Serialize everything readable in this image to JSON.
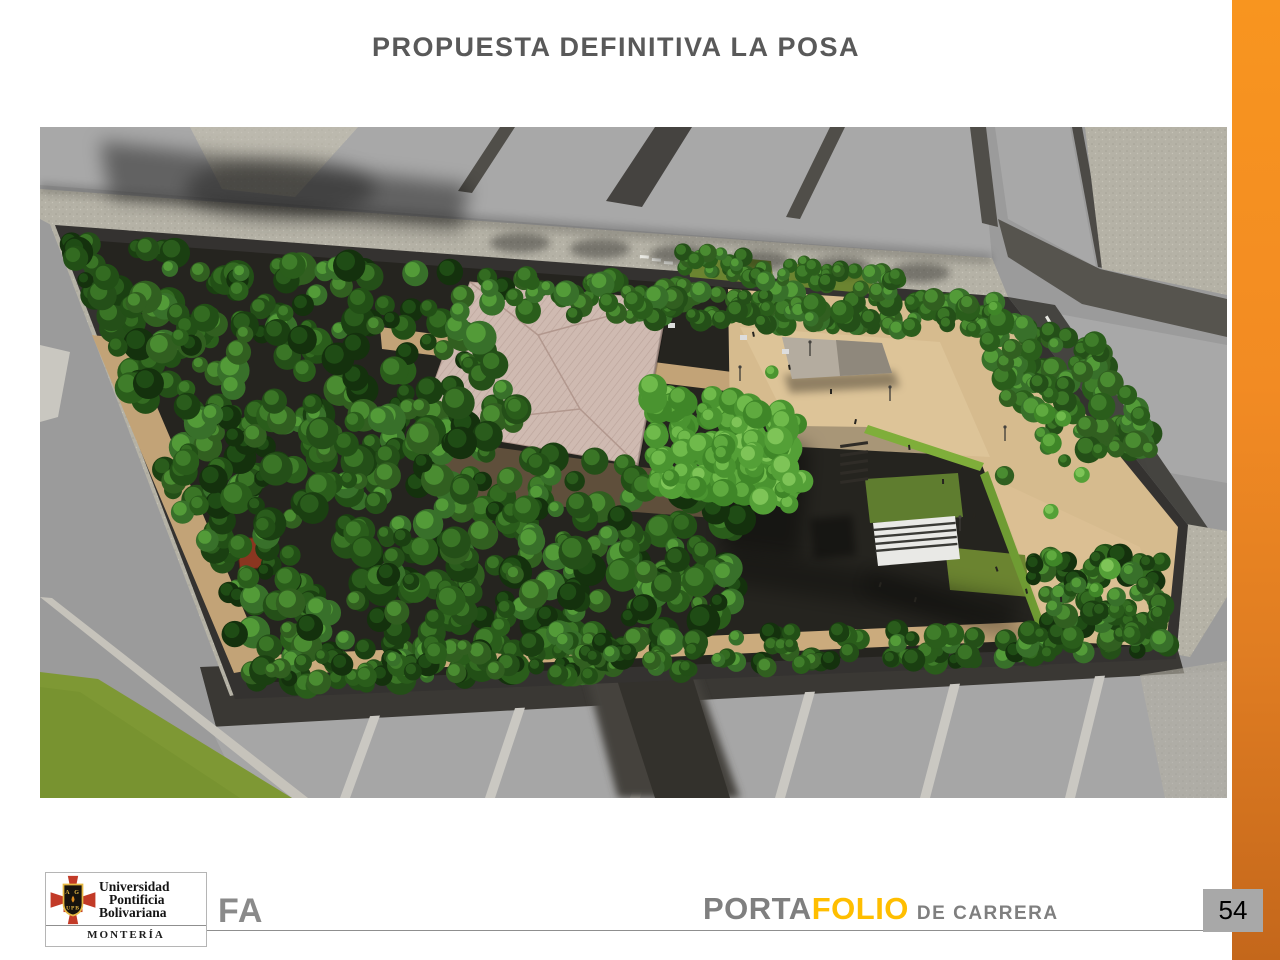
{
  "slide": {
    "title": "PROPUESTA DEFINITIVA LA POSA",
    "page_number": "54"
  },
  "footer": {
    "faculty_code": "FA",
    "portfolio_word_gray": "PORTA",
    "portfolio_word_yellow": "FOLIO",
    "portfolio_suffix": "DE CARRERA"
  },
  "logo": {
    "university_line1": "Universidad",
    "university_line2": "Pontificia",
    "university_line3": "Bolivariana",
    "campus_city": "MONTERÍA",
    "shield_initials_top": "A G",
    "shield_initials_bottom": "UPB"
  },
  "colors": {
    "title_text": "#595959",
    "footer_text": "#7F7F7F",
    "portfolio_yellow": "#FFBE00",
    "sidebar_orange_top": "#F8951F",
    "sidebar_orange_bottom": "#C4671B",
    "page_badge_bg": "#A8A8A8",
    "crest_red": "#C23A27",
    "crest_gold": "#E6B844"
  }
}
